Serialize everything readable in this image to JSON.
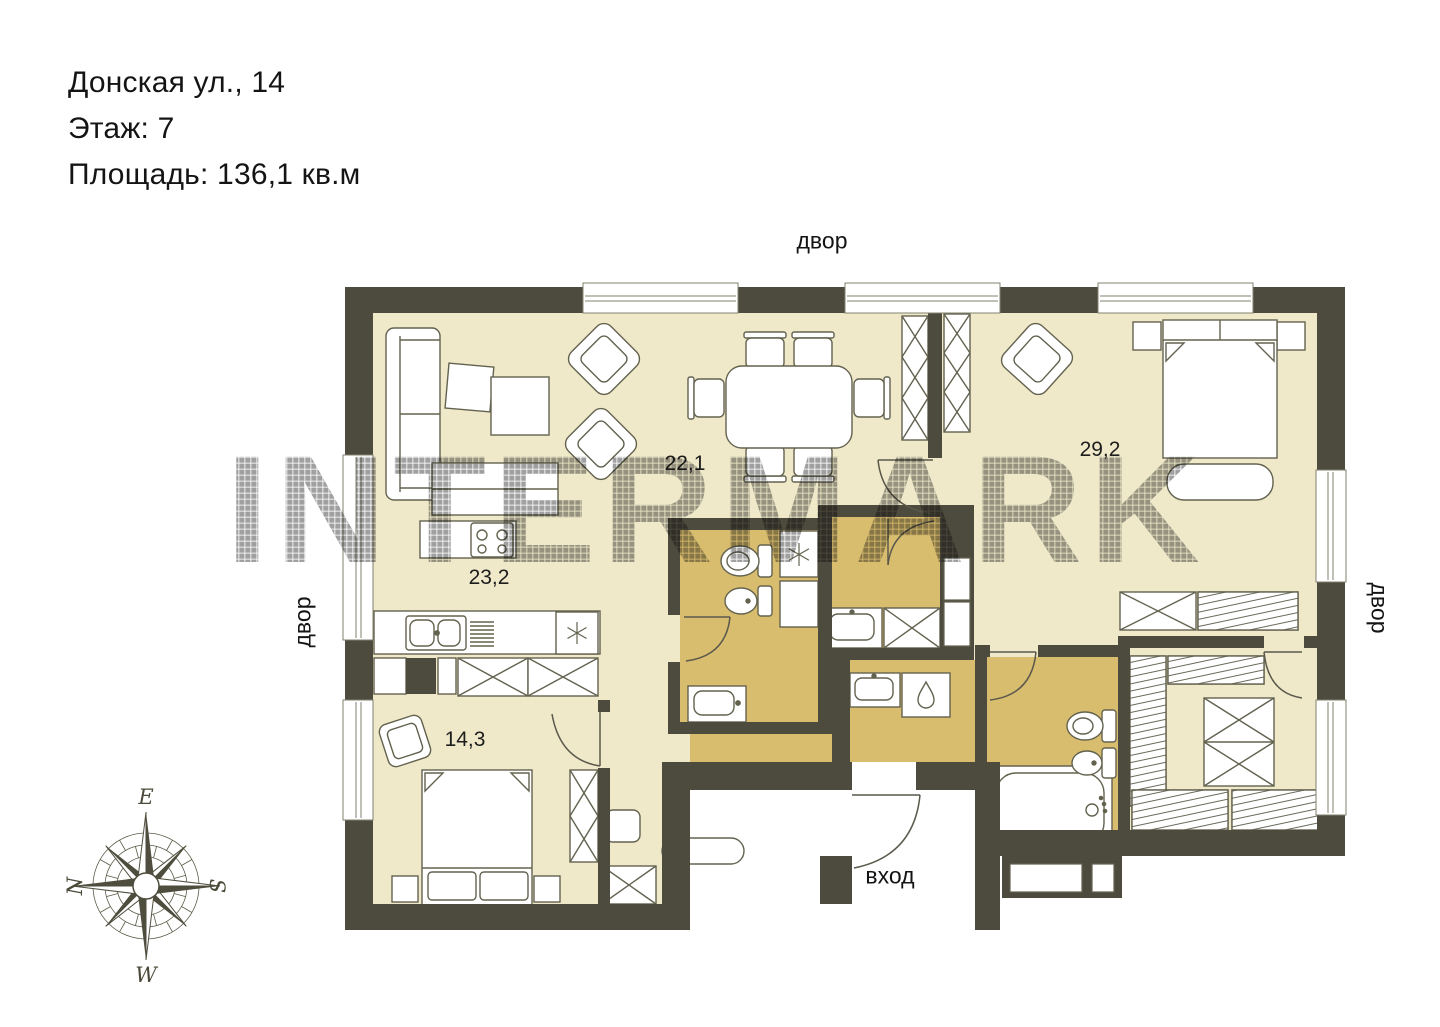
{
  "listing": {
    "address": "Донская ул., 14",
    "floor": "Этаж: 7",
    "area": "Площадь: 136,1 кв.м"
  },
  "watermark": "INTERMARK",
  "labels": {
    "courtyard_top": "двор",
    "courtyard_left": "двор",
    "courtyard_right": "двор",
    "entrance": "вход"
  },
  "rooms": [
    {
      "name": "living-dining",
      "area": "22,1"
    },
    {
      "name": "kitchen",
      "area": "23,2"
    },
    {
      "name": "bedroom-right",
      "area": "29,2"
    },
    {
      "name": "bedroom-left",
      "area": "14,3"
    }
  ],
  "compass": {
    "top": "E",
    "right": "S",
    "bottom": "W",
    "left": "N"
  },
  "colors": {
    "wall": "#4d4b3d",
    "floor": "#efe9ca",
    "wet_floor": "#d9bd6f",
    "outline": "#63624f",
    "watermark": "#8f8f8f"
  }
}
